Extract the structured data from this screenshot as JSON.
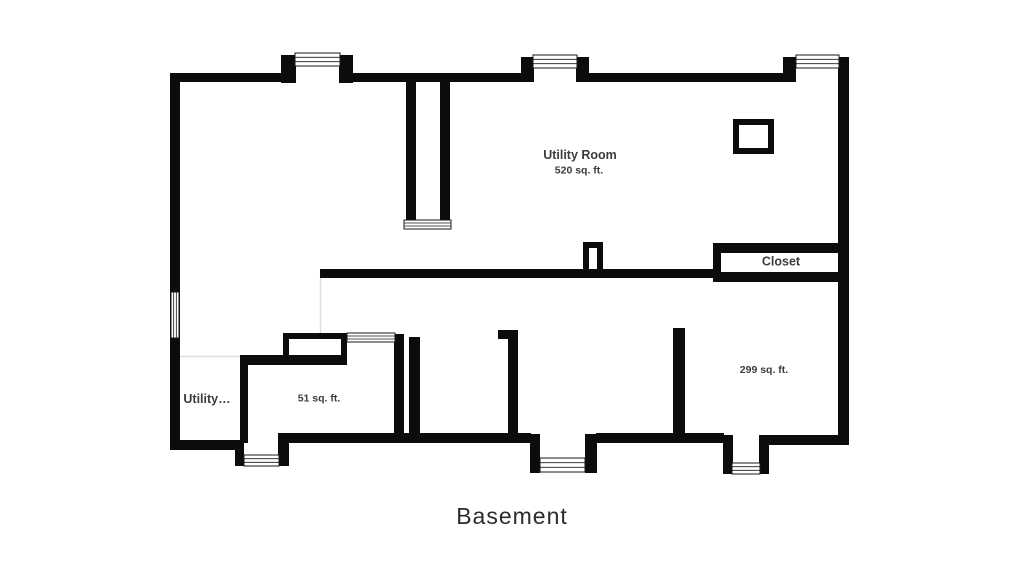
{
  "title": {
    "text": "Basement"
  },
  "colors": {
    "background": "#ffffff",
    "wall": "#0c0c0c",
    "label": "#3d3d3d",
    "title": "#2b2b2b",
    "thin_line": "#dcdcdc",
    "window_fill": "#ffffff",
    "window_stroke": "#1a1a1a"
  },
  "labels": [
    {
      "name": "label-utility-room",
      "text": "Utility Room",
      "x": 580,
      "y": 159,
      "size": 12.5
    },
    {
      "name": "label-utility-room-area",
      "text": "520 sq. ft.",
      "x": 579,
      "y": 173.5,
      "size": 10.5
    },
    {
      "name": "label-closet",
      "text": "Closet",
      "x": 781,
      "y": 265.5,
      "size": 12.5
    },
    {
      "name": "label-room-299-area",
      "text": "299 sq. ft.",
      "x": 764,
      "y": 373,
      "size": 10.5
    },
    {
      "name": "label-utility-truncated",
      "text": "Utility…",
      "x": 207,
      "y": 403,
      "size": 12.5
    },
    {
      "name": "label-room-51-area",
      "text": "51 sq. ft.",
      "x": 319,
      "y": 401.5,
      "size": 10.5
    }
  ],
  "floorplan": {
    "walls": [
      {
        "x": 170,
        "y": 73,
        "w": 120,
        "h": 9
      },
      {
        "x": 343,
        "y": 73,
        "w": 183,
        "h": 9
      },
      {
        "x": 585,
        "y": 73,
        "w": 203,
        "h": 9
      },
      {
        "x": 281,
        "y": 55,
        "w": 15,
        "h": 28
      },
      {
        "x": 339,
        "y": 55,
        "w": 14,
        "h": 28
      },
      {
        "x": 521,
        "y": 57,
        "w": 13,
        "h": 25
      },
      {
        "x": 576,
        "y": 57,
        "w": 13,
        "h": 25
      },
      {
        "x": 783,
        "y": 57,
        "w": 13,
        "h": 25
      },
      {
        "x": 170,
        "y": 73,
        "w": 10,
        "h": 377
      },
      {
        "x": 838,
        "y": 57,
        "w": 11,
        "h": 388
      },
      {
        "x": 406,
        "y": 80,
        "w": 10,
        "h": 141
      },
      {
        "x": 440,
        "y": 80,
        "w": 10,
        "h": 141
      },
      {
        "x": 320,
        "y": 269,
        "w": 398,
        "h": 9
      },
      {
        "x": 583,
        "y": 242,
        "w": 20,
        "h": 6
      },
      {
        "x": 583,
        "y": 242,
        "w": 6,
        "h": 30
      },
      {
        "x": 597,
        "y": 242,
        "w": 6,
        "h": 30
      },
      {
        "x": 733,
        "y": 119,
        "w": 41,
        "h": 6
      },
      {
        "x": 733,
        "y": 148,
        "w": 41,
        "h": 6
      },
      {
        "x": 733,
        "y": 119,
        "w": 6,
        "h": 35
      },
      {
        "x": 768,
        "y": 119,
        "w": 6,
        "h": 35
      },
      {
        "x": 713,
        "y": 243,
        "w": 136,
        "h": 10
      },
      {
        "x": 716,
        "y": 272,
        "w": 133,
        "h": 10
      },
      {
        "x": 713,
        "y": 243,
        "w": 8,
        "h": 39
      },
      {
        "x": 240,
        "y": 355,
        "w": 107,
        "h": 10
      },
      {
        "x": 240,
        "y": 355,
        "w": 8,
        "h": 88
      },
      {
        "x": 283,
        "y": 333,
        "w": 64,
        "h": 6
      },
      {
        "x": 283,
        "y": 333,
        "w": 6,
        "h": 24
      },
      {
        "x": 341,
        "y": 333,
        "w": 6,
        "h": 24
      },
      {
        "x": 394,
        "y": 334,
        "w": 10,
        "h": 109
      },
      {
        "x": 409,
        "y": 337,
        "w": 11,
        "h": 106
      },
      {
        "x": 498,
        "y": 330,
        "w": 20,
        "h": 9
      },
      {
        "x": 508,
        "y": 330,
        "w": 10,
        "h": 110
      },
      {
        "x": 673,
        "y": 328,
        "w": 12,
        "h": 112
      },
      {
        "x": 170,
        "y": 440,
        "w": 74,
        "h": 10
      },
      {
        "x": 278,
        "y": 433,
        "w": 253,
        "h": 10
      },
      {
        "x": 596,
        "y": 433,
        "w": 128,
        "h": 10
      },
      {
        "x": 768,
        "y": 435,
        "w": 81,
        "h": 10
      },
      {
        "x": 235,
        "y": 440,
        "w": 9,
        "h": 26
      },
      {
        "x": 278,
        "y": 436,
        "w": 11,
        "h": 30
      },
      {
        "x": 530,
        "y": 434,
        "w": 10,
        "h": 39
      },
      {
        "x": 585,
        "y": 434,
        "w": 12,
        "h": 39
      },
      {
        "x": 723,
        "y": 435,
        "w": 10,
        "h": 39
      },
      {
        "x": 759,
        "y": 435,
        "w": 10,
        "h": 39
      }
    ],
    "white_patches": [
      {
        "x": 289,
        "y": 339,
        "w": 52,
        "h": 16
      }
    ],
    "windows": [
      {
        "name": "window-top-left",
        "x": 295,
        "y": 53,
        "w": 45,
        "h": 13,
        "o": "h"
      },
      {
        "name": "window-top-middle",
        "x": 533,
        "y": 55,
        "w": 44,
        "h": 13,
        "o": "h"
      },
      {
        "name": "window-top-right",
        "x": 796,
        "y": 55,
        "w": 43,
        "h": 13,
        "o": "h"
      },
      {
        "name": "window-left-wall",
        "x": 171,
        "y": 292,
        "w": 8,
        "h": 46,
        "o": "v"
      },
      {
        "name": "stair-opening",
        "x": 404,
        "y": 220,
        "w": 47,
        "h": 9,
        "o": "h"
      },
      {
        "name": "room-51-opening",
        "x": 347,
        "y": 333,
        "w": 48,
        "h": 9,
        "o": "h"
      },
      {
        "name": "window-well-left",
        "x": 244,
        "y": 455,
        "w": 35,
        "h": 11,
        "o": "h"
      },
      {
        "name": "window-well-middle",
        "x": 540,
        "y": 458,
        "w": 45,
        "h": 14,
        "o": "h"
      },
      {
        "name": "window-well-right",
        "x": 732,
        "y": 463,
        "w": 28,
        "h": 11,
        "o": "h"
      }
    ],
    "thin_lines": [
      {
        "x1": 179,
        "y1": 356.5,
        "x2": 240,
        "y2": 356.5
      },
      {
        "x1": 320.5,
        "y1": 278,
        "x2": 320.5,
        "y2": 334
      }
    ]
  }
}
